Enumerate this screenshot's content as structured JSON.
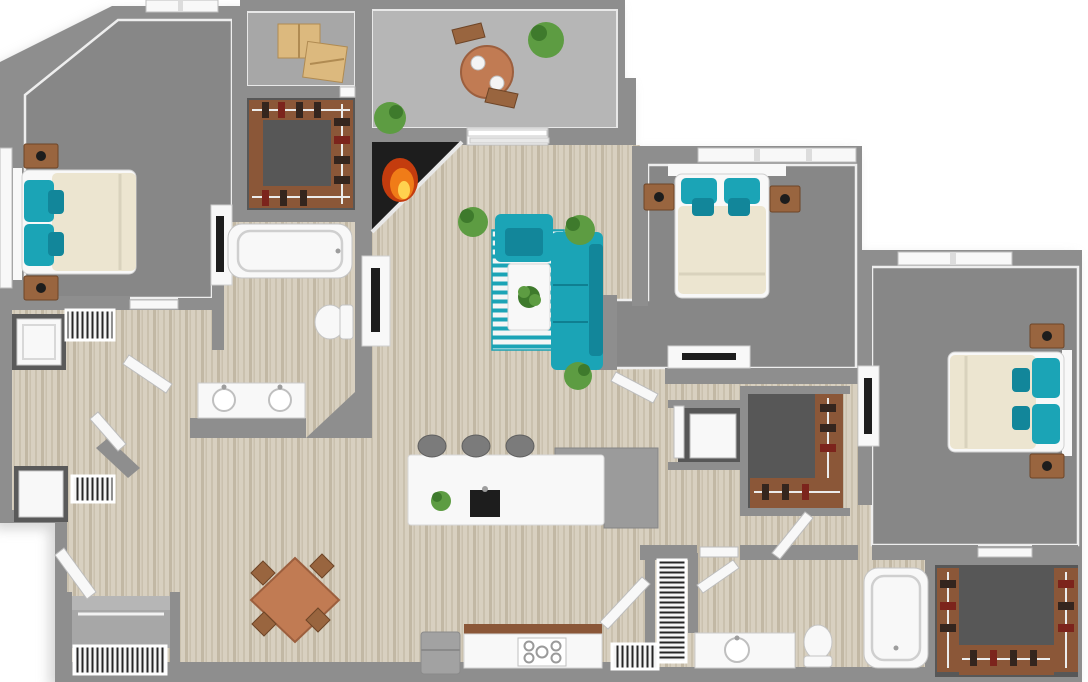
{
  "scene": {
    "kind": "3d-floor-plan-render",
    "rooms": [
      "primary-bedroom",
      "primary-walk-in-closet",
      "storage-room",
      "primary-bathroom",
      "balcony",
      "living-room",
      "kitchen",
      "dining-area",
      "entry",
      "laundry-nook",
      "bedroom-2",
      "bedroom-3",
      "utility-closet",
      "walk-in-closet-2",
      "walk-in-closet-3",
      "bathroom-2",
      "mechanical-closet"
    ],
    "furniture": [
      "bed-with-teal-pillows",
      "nightstands-with-lamps",
      "dresser-with-tv",
      "teal-sectional-sofa",
      "teal-armchair",
      "striped-rug",
      "coffee-table-with-plant",
      "corner-fireplace",
      "kitchen-island-with-sink",
      "bar-stools",
      "range-cooktop",
      "refrigerator",
      "dining-table-with-chairs",
      "patio-table-with-chairs",
      "bathtubs",
      "toilets",
      "vanities-with-sinks",
      "washer-and-dryer",
      "air-vents",
      "closet-shelving-with-clothes",
      "moving-boxes",
      "potted-plants"
    ]
  },
  "colors": {
    "outside": "#ffffff",
    "shadow": "#aeaeae",
    "wall": "#8e8e8e",
    "wall_dark": "#787878",
    "trim": "#f1f1f1",
    "carpet": "#878787",
    "carpet_dark": "#575757",
    "wood_base": "#d8d0c0",
    "wood_stripe": "#cac1ae",
    "wood_stripe2": "#c2b8a4",
    "concrete": "#b6b6b6",
    "concrete_light": "#a7a7a7",
    "white_fixture": "#f8f8f8",
    "fixture_line": "#c4c4c4",
    "cream": "#ece5d0",
    "teal": "#1ba4b6",
    "teal_dark": "#12869a",
    "wood_furniture": "#99653f",
    "closet_wood": "#8b5738",
    "clothes_dark": "#34251e",
    "clothes_red": "#7c241c",
    "table_wood": "#c17b53",
    "plant": "#5d9c42",
    "plant_dark": "#3e7a2c",
    "dark": "#1d1d1d",
    "steel": "#9d9d9d",
    "stool": "#7b7b7b",
    "fire_orange": "#f07c18",
    "fire_yellow": "#ffd24f",
    "fire_red": "#c43c0e",
    "vent_dark": "#262626",
    "tan_box": "#dcb97e",
    "tan_box_edge": "#b08b52",
    "rug_white": "#f4f6f6"
  }
}
